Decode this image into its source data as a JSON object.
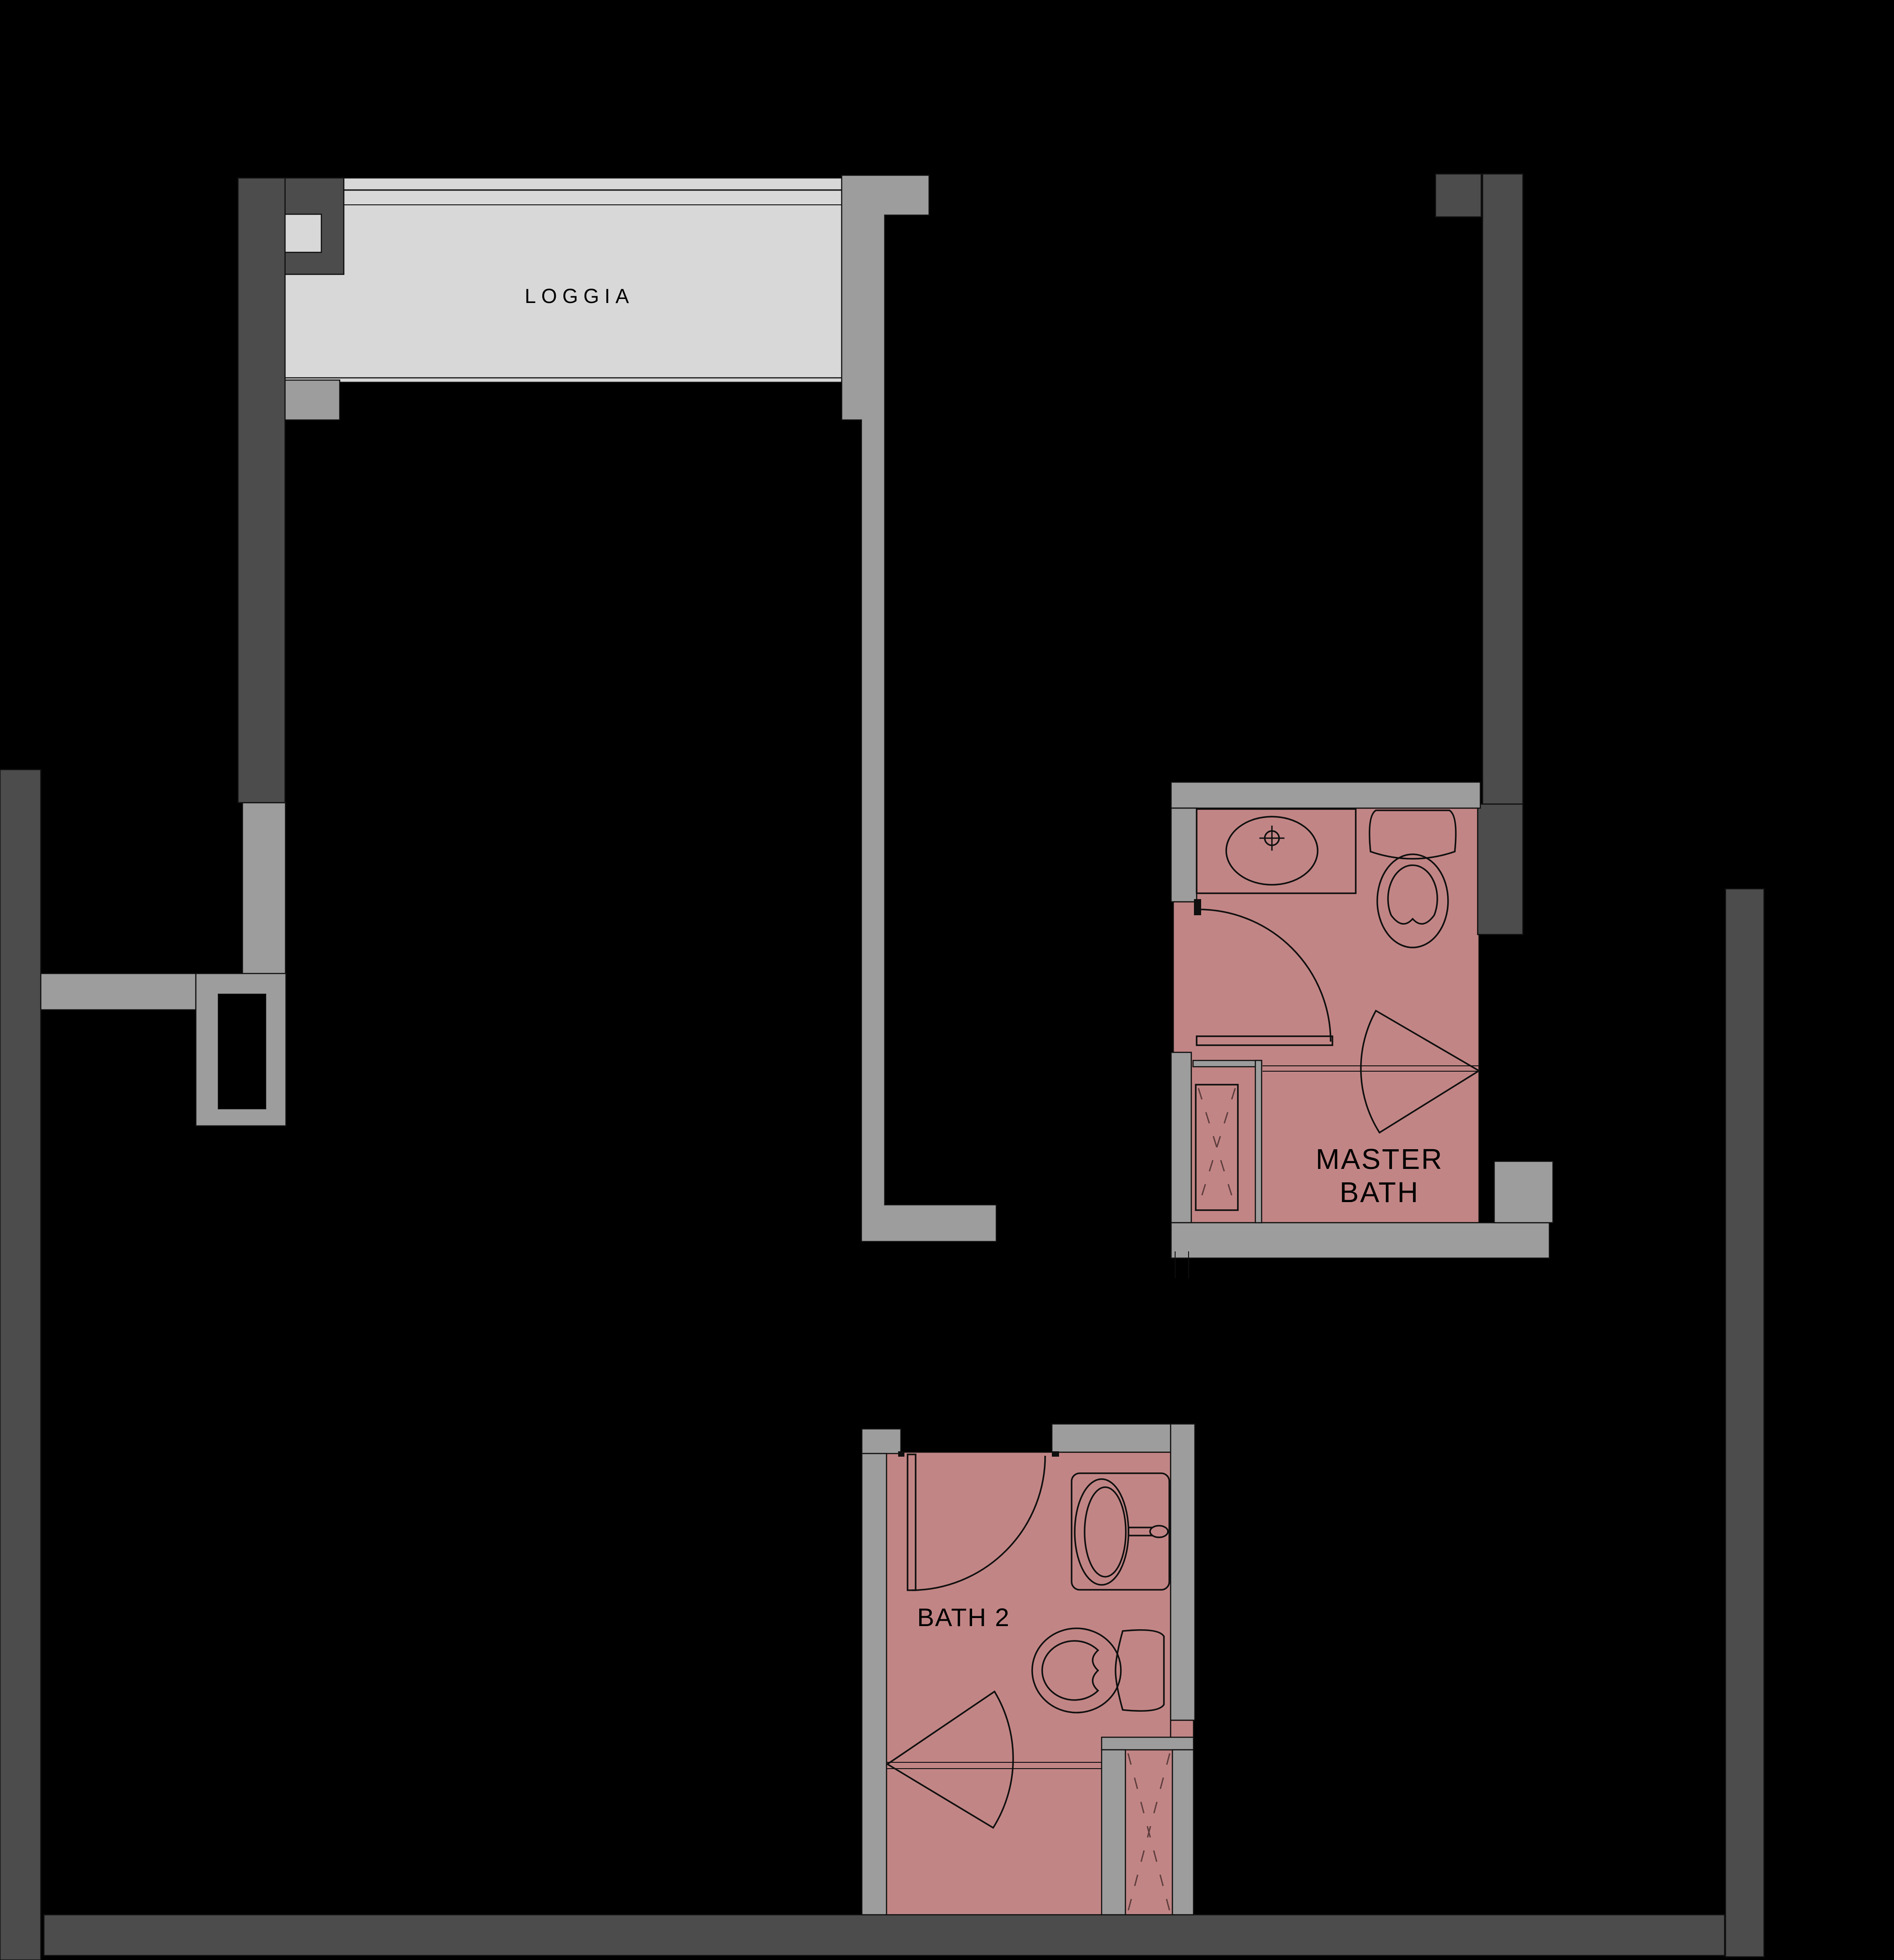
{
  "document": {
    "type": "architectural-floor-plan-fragment"
  },
  "colors": {
    "bg": "#000000",
    "wall_dark": "#4c4c4c",
    "wall_gray": "#9d9d9d",
    "floor_light": "#d8d8d8",
    "room_pink": "#c28585",
    "line": "#0f0f0f",
    "dash": "#5e3d3d",
    "text": "#000000"
  },
  "rooms": {
    "loggia": {
      "label": "LOGGIA"
    },
    "master_bath": {
      "label_line1": "MASTER",
      "label_line2": "BATH"
    },
    "bath2": {
      "label": "BATH 2"
    }
  }
}
